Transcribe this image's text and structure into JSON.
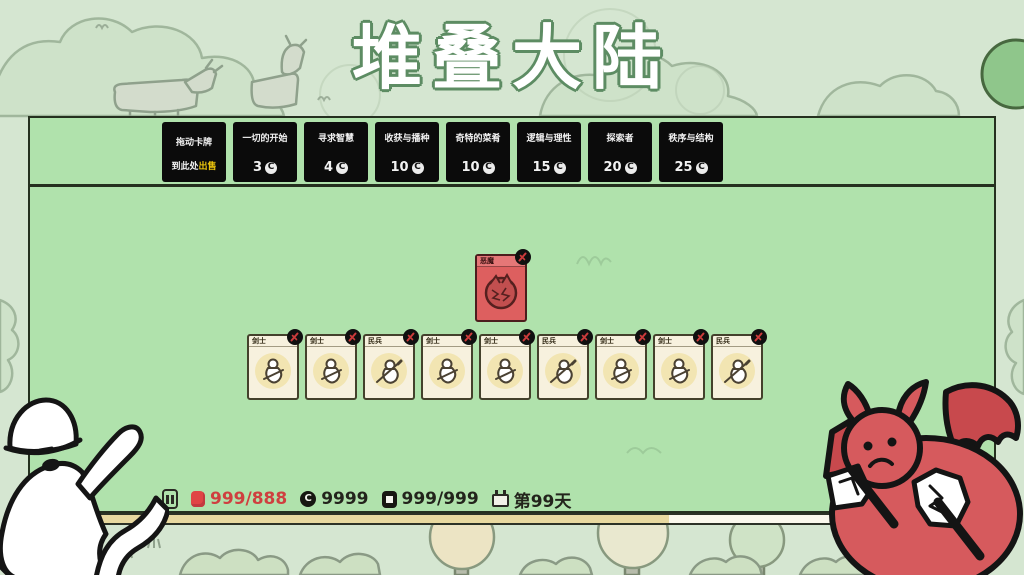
{
  "title": "堆叠大陆",
  "shop": {
    "sell_box": {
      "line1": "拖动卡牌",
      "line2": "到此处",
      "sell_word": "出售"
    },
    "packs": [
      {
        "name": "一切的开始",
        "cost": "3"
      },
      {
        "name": "寻求智慧",
        "cost": "4"
      },
      {
        "name": "收获与播种",
        "cost": "10"
      },
      {
        "name": "奇特的菜肴",
        "cost": "10"
      },
      {
        "name": "逻辑与理性",
        "cost": "15"
      },
      {
        "name": "探索者",
        "cost": "20"
      },
      {
        "name": "秩序与结构",
        "cost": "25"
      }
    ]
  },
  "icons": {
    "coin_letter": "C"
  },
  "cards": {
    "enemy": {
      "name": "恶魔"
    },
    "units": [
      {
        "name": "剑士"
      },
      {
        "name": "剑士"
      },
      {
        "name": "民兵"
      },
      {
        "name": "剑士"
      },
      {
        "name": "剑士"
      },
      {
        "name": "民兵"
      },
      {
        "name": "剑士"
      },
      {
        "name": "剑士"
      },
      {
        "name": "民兵"
      }
    ]
  },
  "status_bar": {
    "food": "999/888",
    "coins": "9999",
    "card_count": "999/999",
    "day": "第99天"
  },
  "colors": {
    "background": "#d5e6d1",
    "board_green": "#b0e2ac",
    "pack_black": "#0b0b0b",
    "sell_yellow": "#ecc50c",
    "enemy_red": "#dd5f5f",
    "unit_cream": "#f7f1de",
    "food_red": "#cf3f3f",
    "day_bar_tan": "#e8d9a0",
    "title_outline_green": "#5d8c63"
  }
}
